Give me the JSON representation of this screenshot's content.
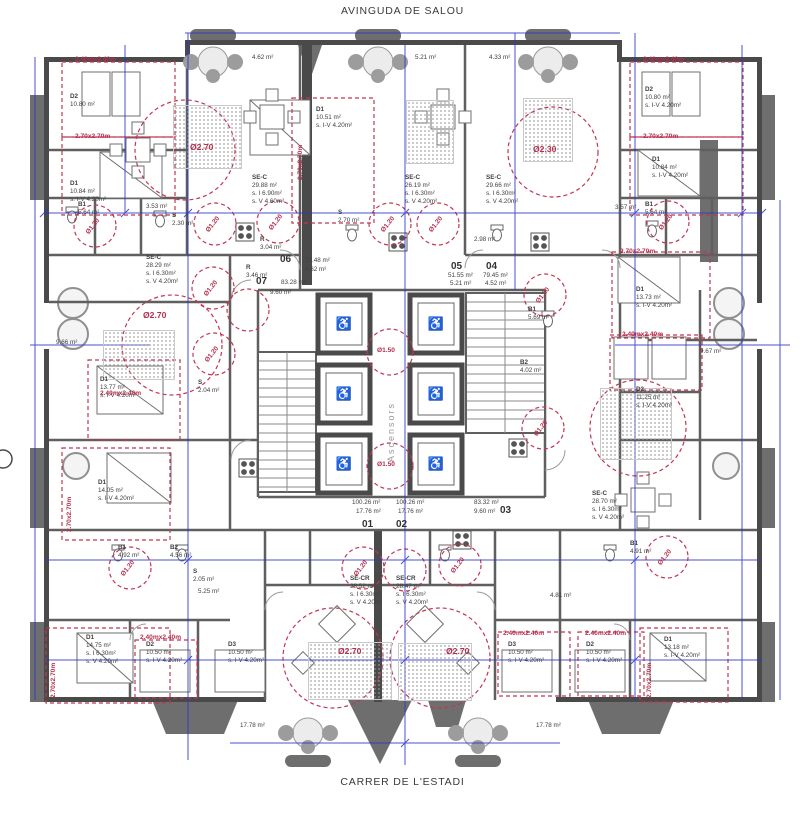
{
  "page": {
    "street_top": "AVINGUDA DE SALOU",
    "street_bottom": "CARRER DE L'ESTADI"
  },
  "icons": {
    "wheelchair": "♿"
  },
  "core": {
    "label": "Ascensors"
  },
  "tags": {
    "bed_240": "2.40mx2.40m",
    "bed_270": "2.70x2.70m",
    "c120": "Ø1.20",
    "c150": "Ø1.50",
    "c270": "Ø2.70",
    "c230": "Ø2.30"
  },
  "units": [
    {
      "id": "07",
      "area": "83.28 m²",
      "terrace": "9.60 m²"
    },
    {
      "id": "06",
      "area": "72.48 m²",
      "terrace": "4.62 m²"
    },
    {
      "id": "05",
      "area": "51.55 m²",
      "terrace": "5.21 m²"
    },
    {
      "id": "04",
      "area": "79.45 m²",
      "terrace": "4.52 m²"
    },
    {
      "id": "01",
      "area": "100.26 m²",
      "terrace": "17.76 m²"
    },
    {
      "id": "02",
      "area": "100.26 m²",
      "terrace": "17.76 m²"
    },
    {
      "id": "03",
      "area": "83.32 m²",
      "terrace": "9.60 m²"
    }
  ],
  "rooms": [
    {
      "name": "D2",
      "area": "10.80 m²"
    },
    {
      "name": "D1",
      "area": "10.84 m²",
      "s1": "s. I-V 4.20m²"
    },
    {
      "name": "B1",
      "area": "5.64 m²"
    },
    {
      "name": "",
      "area": "3.53 m²"
    },
    {
      "name": "S",
      "area": "2.30 m²"
    },
    {
      "name": "SE-C",
      "area": "28.29 m²",
      "s1": "s. I 6.30m²",
      "s2": "s. V 4.20m²"
    },
    {
      "name": "R",
      "area": "3.46 m²"
    },
    {
      "name": "SE-C",
      "area": "29.88 m²",
      "s1": "s. I 6.90m²",
      "s2": "s. V 4.60m²"
    },
    {
      "name": "D1",
      "area": "10.51 m²",
      "s1": "s. I-V 4.20m²"
    },
    {
      "name": "SE-C",
      "area": "26.19 m²",
      "s1": "s. I 6.30m²",
      "s2": "s. V 4.20m²"
    },
    {
      "name": "SE-C",
      "area": "29.66 m²",
      "s1": "s. I 6.30m²",
      "s2": "s. V 4.20m²"
    },
    {
      "name": "S",
      "area": "2.70 m²"
    },
    {
      "name": "",
      "area": "2.98 m²"
    },
    {
      "name": "R",
      "area": "3.04 m²"
    },
    {
      "name": "B1",
      "area": "5.69 m²"
    },
    {
      "name": "",
      "area": "9.66 m²"
    },
    {
      "name": "D1",
      "area": "13.77 m²",
      "s1": "s. I-V 4.20m²"
    },
    {
      "name": "S",
      "area": "2.04 m²"
    },
    {
      "name": "D2",
      "area": "10.80 m²",
      "s1": "s. I-V 4.20m²"
    },
    {
      "name": "D1",
      "area": "10.84 m²",
      "s1": "s. I-V 4.20m²"
    },
    {
      "name": "B1",
      "area": "5.64 m²"
    },
    {
      "name": "",
      "area": "3.57 m²"
    },
    {
      "name": "D1",
      "area": "13.73 m²",
      "s1": "s. I-V 4.20m²"
    },
    {
      "name": "",
      "area": "9.67 m²"
    },
    {
      "name": "D2",
      "area": "11.25 m²",
      "s1": "s. I-V 4.20m²"
    },
    {
      "name": "B2",
      "area": "4.02 m²"
    },
    {
      "name": "D1",
      "area": "14.05 m²",
      "s1": "s. I-V 4.20m²"
    },
    {
      "name": "B1",
      "area": "4.92 m²"
    },
    {
      "name": "B2",
      "area": "4.56 m²"
    },
    {
      "name": "S",
      "area": "2.05 m²"
    },
    {
      "name": "",
      "area": "5.25 m²"
    },
    {
      "name": "D1",
      "area": "14.75 m²",
      "s1": "s. I 6.30m²",
      "s2": "s. V 4.20m²"
    },
    {
      "name": "D2",
      "area": "10.50 m²",
      "s1": "s. I-V 4.20m²"
    },
    {
      "name": "D3",
      "area": "10.50 m²",
      "s1": "s. I-V 4.20m²"
    },
    {
      "name": "SE-CR",
      "area": "28.52 m²",
      "s1": "s. I 6.30m²",
      "s2": "s. V 4.20m²"
    },
    {
      "name": "SE-CR",
      "area": "28.47 m²",
      "s1": "s. I 6.30m²",
      "s2": "s. V 4.20m²"
    },
    {
      "name": "D3",
      "area": "10.50 m²",
      "s1": "s. I-V 4.20m²"
    },
    {
      "name": "D2",
      "area": "10.50 m²",
      "s1": "s. I-V 4.20m²"
    },
    {
      "name": "D1",
      "area": "13.18 m²",
      "s1": "s. I-V 4.20m²"
    },
    {
      "name": "SE-C",
      "area": "28.70 m²",
      "s1": "s. I 6.30m²",
      "s2": "s. V 4.20m²"
    },
    {
      "name": "B1",
      "area": "4.91 m²"
    },
    {
      "name": "",
      "area": "4.81 m²"
    }
  ],
  "terraces": [
    {
      "area": "4.62 m²"
    },
    {
      "area": "5.21 m²"
    },
    {
      "area": "4.33 m²"
    },
    {
      "area": "17.78 m²"
    },
    {
      "area": "17.78 m²"
    }
  ]
}
